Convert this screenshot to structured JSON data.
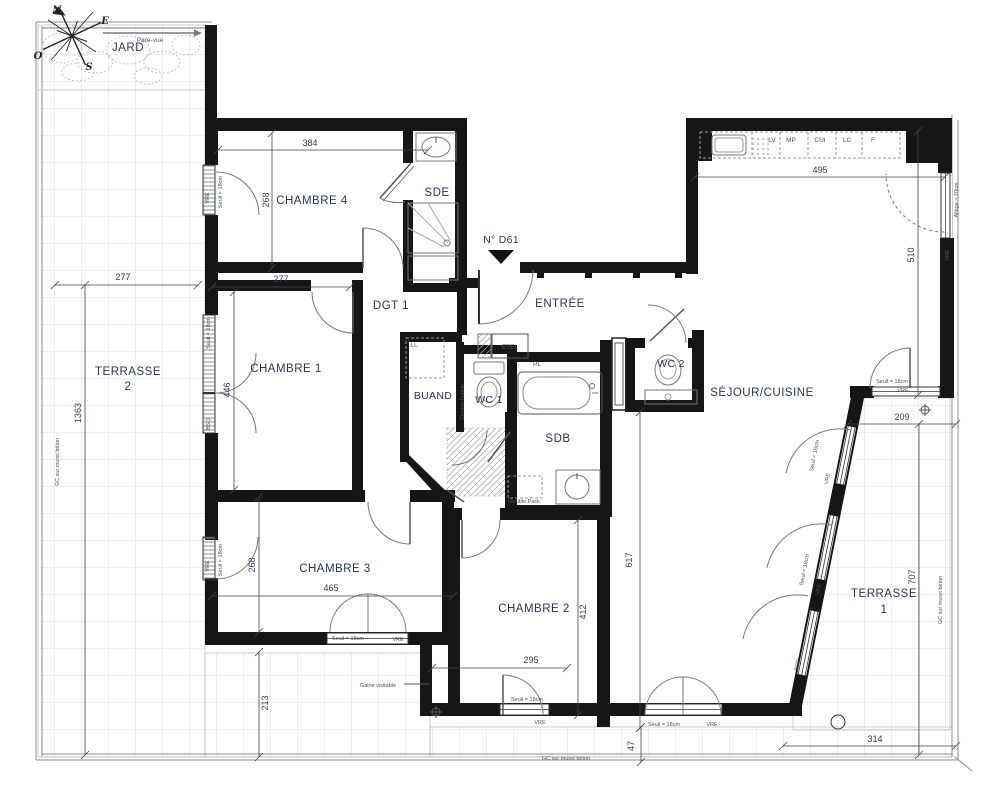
{
  "compass": {
    "n": "N",
    "e": "E",
    "s": "S",
    "o": "O"
  },
  "garden": {
    "label": "JARD",
    "pare_vue": "Pare-vue"
  },
  "unit": {
    "door_label": "N° D61"
  },
  "rooms": {
    "terrasse2_line1": "TERRASSE",
    "terrasse2_line2": "2",
    "chambre4": "CHAMBRE 4",
    "sde": "SDE",
    "dgt": "DGT 1",
    "entree": "ENTRÉE",
    "chambre1": "CHAMBRE 1",
    "buand": "BUAND",
    "wc1": "WC 1",
    "sdb": "SDB",
    "wc2": "WC 2",
    "sejour": "SÉJOUR/CUISINE",
    "chambre3": "CHAMBRE 3",
    "chambre2": "CHAMBRE 2",
    "terrasse1_line1": "TERRASSE",
    "terrasse1_line2": "1"
  },
  "kitchen": {
    "lv": "LV",
    "mp": "MP",
    "cui": "CUI",
    "lc": "LC",
    "f": "F"
  },
  "annotations": {
    "seuil": "Seuil = 18cm",
    "vre": "VRE",
    "bso": "BSO",
    "allege": "Allège = 70cm",
    "gc": "GC sur muret béton",
    "etel": "ETEL",
    "pl": "PL",
    "ll": "LL",
    "cloison": "Cloison fusible",
    "meuble": "Meuble Pack",
    "gaine": "Gaine visitable"
  },
  "dims": {
    "c4_w": "384",
    "c4_h": "268",
    "t2_w": "277",
    "c1_w": "277",
    "c1_h": "446",
    "t2_h": "1363",
    "k_w": "495",
    "sej_h": "510",
    "t1_w": "209",
    "t1_h": "707",
    "t1_b": "314",
    "c3_w": "465",
    "c3_h": "268",
    "c2_w": "295",
    "c2_h": "412",
    "liv_h": "617",
    "t2_b": "213",
    "strip": "47"
  }
}
